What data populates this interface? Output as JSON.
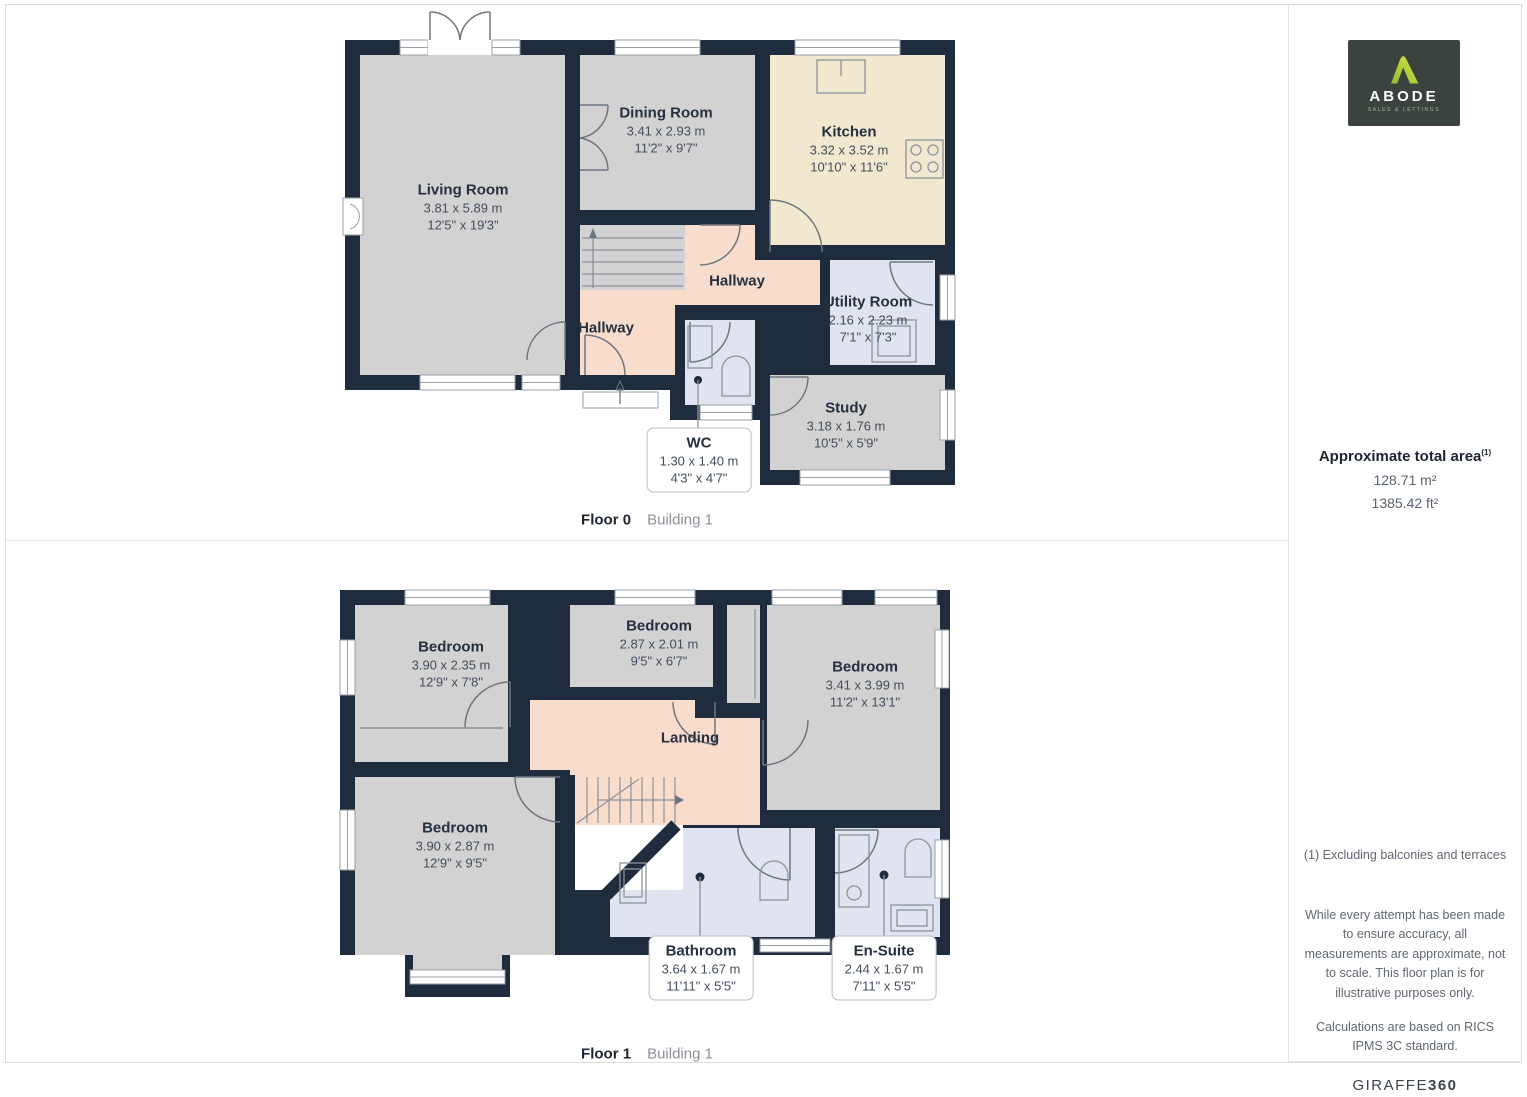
{
  "floor0": {
    "caption": {
      "floor": "Floor 0",
      "building": "Building 1"
    },
    "rooms": {
      "living": {
        "name": "Living Room",
        "dims_m": "3.81 x 5.89 m",
        "dims_ft": "12'5\" x 19'3\""
      },
      "dining": {
        "name": "Dining Room",
        "dims_m": "3.41 x 2.93 m",
        "dims_ft": "11'2\" x 9'7\""
      },
      "kitchen": {
        "name": "Kitchen",
        "dims_m": "3.32 x 3.52 m",
        "dims_ft": "10'10\" x 11'6\""
      },
      "hallway": {
        "name": "Hallway"
      },
      "hallway2": {
        "name": "Hallway"
      },
      "utility": {
        "name": "Utility Room",
        "dims_m": "2.16 x 2.23 m",
        "dims_ft": "7'1\" x 7'3\""
      },
      "wc": {
        "name": "WC",
        "dims_m": "1.30 x 1.40 m",
        "dims_ft": "4'3\" x 4'7\""
      },
      "study": {
        "name": "Study",
        "dims_m": "3.18 x 1.76 m",
        "dims_ft": "10'5\" x 5'9\""
      }
    }
  },
  "floor1": {
    "caption": {
      "floor": "Floor 1",
      "building": "Building 1"
    },
    "rooms": {
      "bedroom1": {
        "name": "Bedroom",
        "dims_m": "3.90 x 2.35 m",
        "dims_ft": "12'9\" x 7'8\""
      },
      "bedroom2": {
        "name": "Bedroom",
        "dims_m": "2.87 x 2.01 m",
        "dims_ft": "9'5\" x 6'7\""
      },
      "bedroom3": {
        "name": "Bedroom",
        "dims_m": "3.41 x 3.99 m",
        "dims_ft": "11'2\" x 13'1\""
      },
      "bedroom4": {
        "name": "Bedroom",
        "dims_m": "3.90 x 2.87 m",
        "dims_ft": "12'9\" x 9'5\""
      },
      "landing": {
        "name": "Landing"
      },
      "bathroom": {
        "name": "Bathroom",
        "dims_m": "3.64 x 1.67 m",
        "dims_ft": "11'11\" x 5'5\""
      },
      "ensuite": {
        "name": "En-Suite",
        "dims_m": "2.44 x 1.67 m",
        "dims_ft": "7'11\" x 5'5\""
      }
    }
  },
  "sidebar": {
    "logo": {
      "brand": "ABODE",
      "tagline": "SALES & LETTINGS"
    },
    "area": {
      "title": "Approximate total area",
      "superscript": "(1)",
      "m2": "128.71 m²",
      "ft2": "1385.42 ft²"
    },
    "note": "(1) Excluding balconies and terraces",
    "disclaimer1": "While every attempt has been made to ensure accuracy, all measurements are approximate, not to scale. This floor plan is for illustrative purposes only.",
    "disclaimer2": "Calculations are based on RICS IPMS 3C standard.",
    "watermark": {
      "name": "GIRAFFE",
      "suffix": "360"
    }
  },
  "colors": {
    "wall": "#1f2c3e",
    "room": "#d2d2d2",
    "kitchen": "#f2e8cf",
    "hall": "#f8dccc",
    "wet": "#dfe4f0",
    "logo_green": "#a6cb3d"
  }
}
